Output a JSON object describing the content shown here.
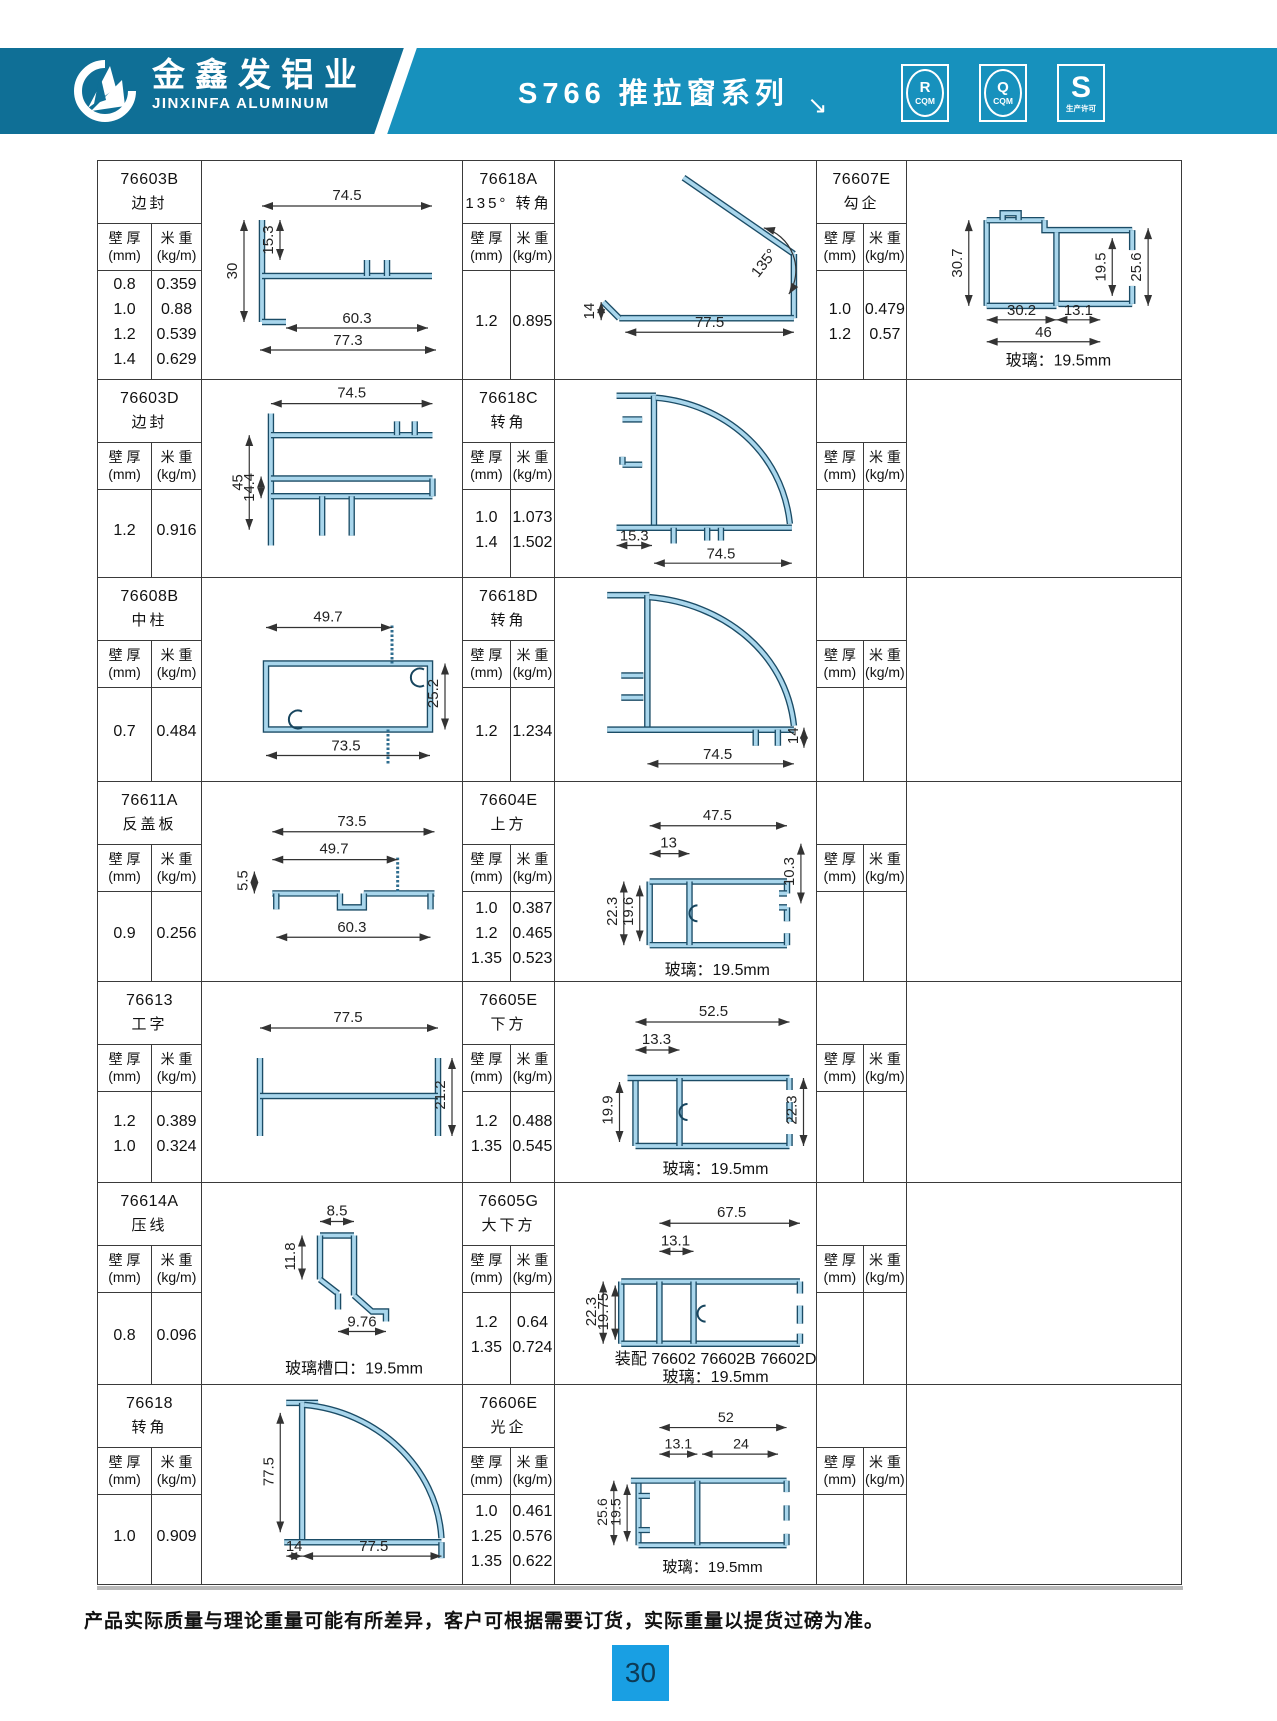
{
  "header": {
    "company_cn": "金鑫发铝业",
    "company_en": "JINXINFA ALUMINUM",
    "series_title": "S766 推拉窗系列",
    "arrow": "↘",
    "badges": [
      {
        "top": "R",
        "bottom": "CQM"
      },
      {
        "top": "Q",
        "bottom": "CQM"
      },
      {
        "top": "S",
        "bottom": "生产许可"
      }
    ],
    "band_color_left": "#0f6f96",
    "band_color_right": "#1791bd"
  },
  "table": {
    "labels": {
      "thickness_l1": "壁 厚",
      "thickness_l2": "(mm)",
      "weight_l1": "米 重",
      "weight_l2": "(kg/m)"
    },
    "rows": [
      {
        "info1": {
          "code": "76603B",
          "name": "边封",
          "thickness": [
            "0.8",
            "1.0",
            "1.2",
            "1.4"
          ],
          "weight": [
            "0.359",
            "0.88",
            "0.539",
            "0.629"
          ]
        },
        "draw1": {
          "key": "a",
          "dims": [
            "74.5",
            "15.3",
            "30",
            "60.3",
            "77.3"
          ],
          "notes": []
        },
        "info2": {
          "code": "76618A",
          "name": "135° 转角",
          "thickness": [
            "1.2"
          ],
          "weight": [
            "0.895"
          ]
        },
        "draw2": {
          "key": "b",
          "dims": [
            "135°",
            "77.5",
            "14"
          ],
          "notes": []
        },
        "info3": {
          "code": "76607E",
          "name": "勾企",
          "thickness": [
            "1.0",
            "1.2"
          ],
          "weight": [
            "0.479",
            "0.57"
          ]
        },
        "draw3": {
          "key": "c",
          "dims": [
            "30.7",
            "19.5",
            "25.6",
            "30.2",
            "13.1",
            "46"
          ],
          "notes": [
            "玻璃：19.5mm"
          ]
        }
      },
      {
        "info1": {
          "code": "76603D",
          "name": "边封",
          "thickness": [
            "1.2"
          ],
          "weight": [
            "0.916"
          ]
        },
        "draw1": {
          "key": "d",
          "dims": [
            "74.5",
            "45",
            "14.4"
          ],
          "notes": []
        },
        "info2": {
          "code": "76618C",
          "name": "转角",
          "thickness": [
            "1.0",
            "1.4"
          ],
          "weight": [
            "1.073",
            "1.502"
          ]
        },
        "draw2": {
          "key": "e",
          "dims": [
            "15.3",
            "74.5"
          ],
          "notes": []
        },
        "info3": {
          "code": "",
          "name": "",
          "thickness": [],
          "weight": []
        },
        "draw3": null
      },
      {
        "info1": {
          "code": "76608B",
          "name": "中柱",
          "thickness": [
            "0.7"
          ],
          "weight": [
            "0.484"
          ]
        },
        "draw1": {
          "key": "f",
          "dims": [
            "49.7",
            "25.2",
            "73.5"
          ],
          "notes": []
        },
        "info2": {
          "code": "76618D",
          "name": "转角",
          "thickness": [
            "1.2"
          ],
          "weight": [
            "1.234"
          ]
        },
        "draw2": {
          "key": "g",
          "dims": [
            "74.5",
            "14"
          ],
          "notes": []
        },
        "info3": {
          "code": "",
          "name": "",
          "thickness": [],
          "weight": []
        },
        "draw3": null
      },
      {
        "info1": {
          "code": "76611A",
          "name": "反盖板",
          "thickness": [
            "0.9"
          ],
          "weight": [
            "0.256"
          ]
        },
        "draw1": {
          "key": "h",
          "dims": [
            "73.5",
            "49.7",
            "5.5",
            "60.3"
          ],
          "notes": []
        },
        "info2": {
          "code": "76604E",
          "name": "上方",
          "thickness": [
            "1.0",
            "1.2",
            "1.35"
          ],
          "weight": [
            "0.387",
            "0.465",
            "0.523"
          ]
        },
        "draw2": {
          "key": "i",
          "dims": [
            "47.5",
            "13",
            "22.3",
            "19.6",
            "10.3"
          ],
          "notes": [
            "玻璃：19.5mm"
          ]
        },
        "info3": {
          "code": "",
          "name": "",
          "thickness": [],
          "weight": []
        },
        "draw3": null
      },
      {
        "info1": {
          "code": "76613",
          "name": "工字",
          "thickness": [
            "1.2",
            "1.0"
          ],
          "weight": [
            "0.389",
            "0.324"
          ]
        },
        "draw1": {
          "key": "j",
          "dims": [
            "77.5",
            "21.2"
          ],
          "notes": []
        },
        "info2": {
          "code": "76605E",
          "name": "下方",
          "thickness": [
            "1.2",
            "1.35"
          ],
          "weight": [
            "0.488",
            "0.545"
          ]
        },
        "draw2": {
          "key": "k",
          "dims": [
            "52.5",
            "13.3",
            "19.9",
            "22.3"
          ],
          "notes": [
            "玻璃：19.5mm"
          ]
        },
        "info3": {
          "code": "",
          "name": "",
          "thickness": [],
          "weight": []
        },
        "draw3": null
      },
      {
        "info1": {
          "code": "76614A",
          "name": "压线",
          "thickness": [
            "0.8"
          ],
          "weight": [
            "0.096"
          ]
        },
        "draw1": {
          "key": "l",
          "dims": [
            "8.5",
            "11.8",
            "9.76"
          ],
          "notes": [
            "玻璃槽口：19.5mm"
          ]
        },
        "info2": {
          "code": "76605G",
          "name": "大下方",
          "thickness": [
            "1.2",
            "1.35"
          ],
          "weight": [
            "0.64",
            "0.724"
          ]
        },
        "draw2": {
          "key": "m",
          "dims": [
            "67.5",
            "13.1",
            "22.3",
            "19.75"
          ],
          "notes": [
            "装配 76602  76602B 76602D",
            "玻璃：19.5mm"
          ]
        },
        "info3": {
          "code": "",
          "name": "",
          "thickness": [],
          "weight": []
        },
        "draw3": null
      },
      {
        "info1": {
          "code": "76618",
          "name": "转角",
          "thickness": [
            "1.0"
          ],
          "weight": [
            "0.909"
          ]
        },
        "draw1": {
          "key": "n",
          "dims": [
            "77.5",
            "14",
            "77.5"
          ],
          "notes": []
        },
        "info2": {
          "code": "76606E",
          "name": "光企",
          "thickness": [
            "1.0",
            "1.25",
            "1.35"
          ],
          "weight": [
            "0.461",
            "0.576",
            "0.622"
          ]
        },
        "draw2": {
          "key": "o",
          "dims": [
            "52",
            "13.1",
            "24",
            "25.6",
            "19.5"
          ],
          "notes": [
            "玻璃：19.5mm"
          ]
        },
        "info3": {
          "code": "",
          "name": "",
          "thickness": [],
          "weight": []
        },
        "draw3": null
      }
    ]
  },
  "footer": {
    "note": "产品实际质量与理论重量可能有所差异，客户可根据需要订货，实际重量以提货过磅为准。",
    "page": "30",
    "page_box_color": "#199fe3"
  }
}
